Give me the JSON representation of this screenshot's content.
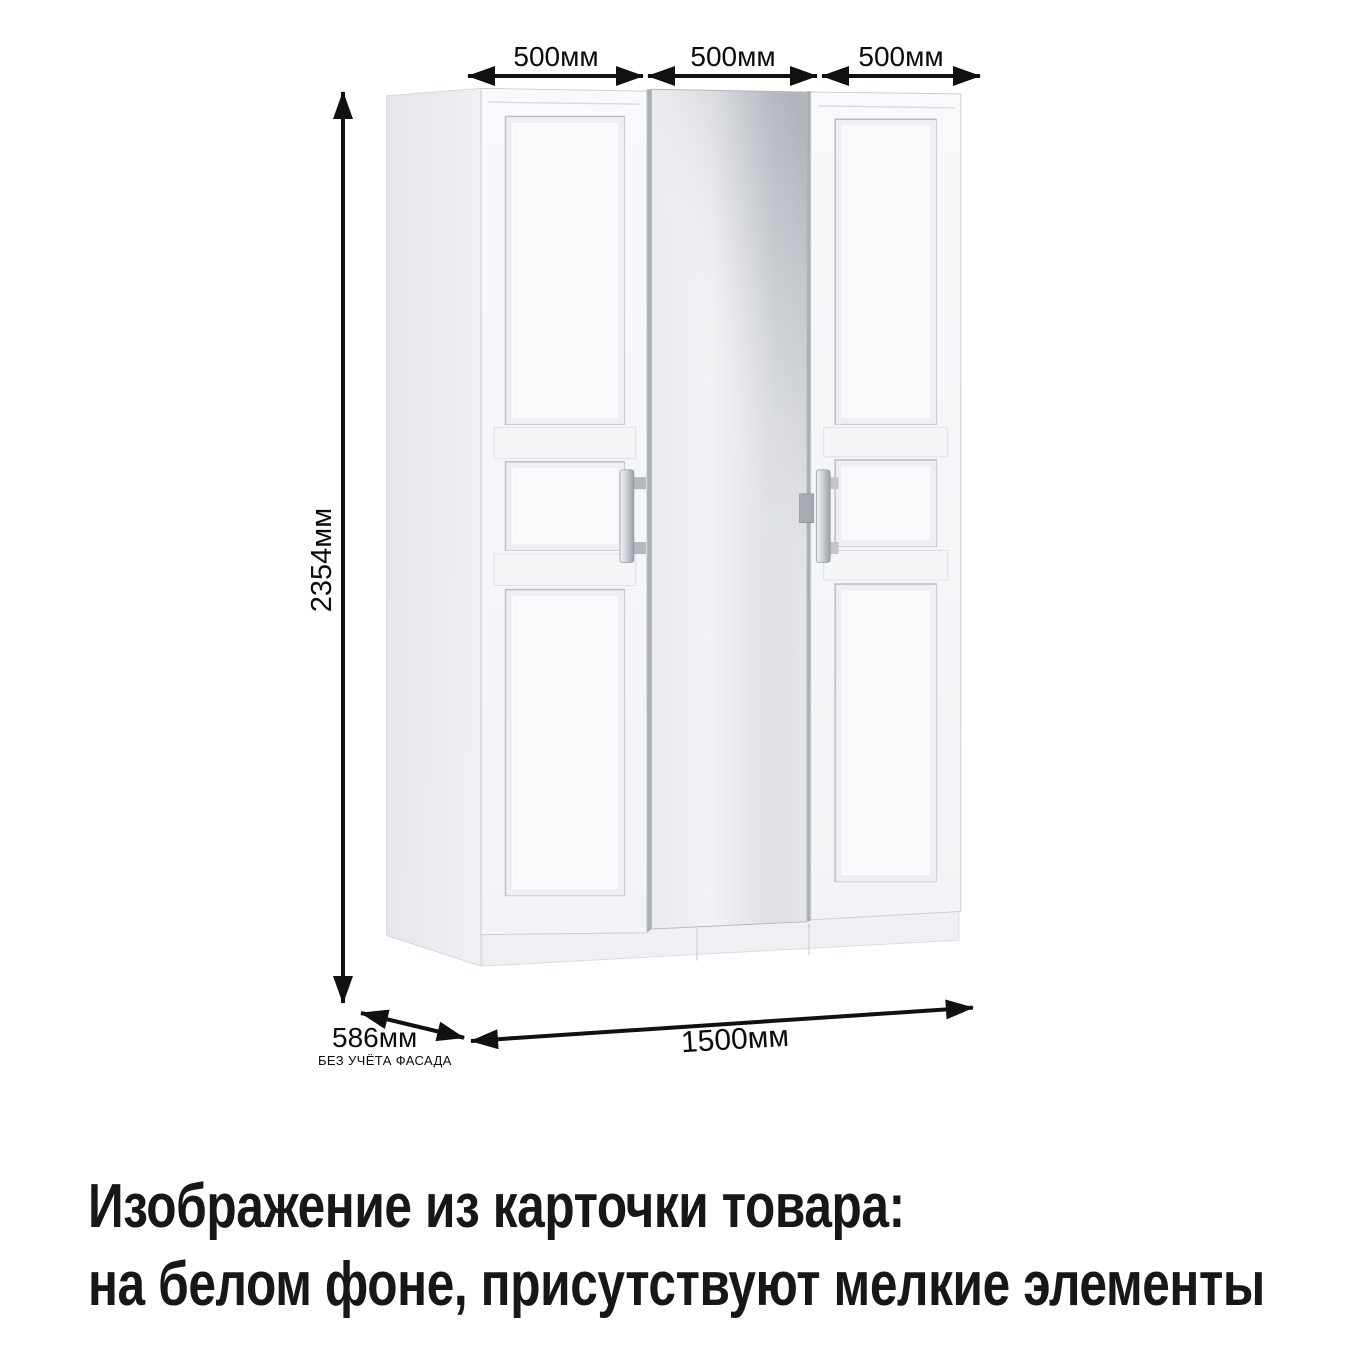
{
  "annotations": {
    "door_width_labels": [
      "500мм",
      "500мм",
      "500мм"
    ],
    "height_label": "2354мм",
    "depth_label": "586мм",
    "depth_sublabel": "БЕЗ УЧЁТА ФАСАДА",
    "total_width_label": "1500мм"
  },
  "caption": {
    "line1": "Изображение из карточки товара:",
    "line2": "на белом фоне, присутствуют мелкие элементы"
  },
  "illustration": {
    "subject": "three-door-wardrobe-with-center-mirror",
    "colors": {
      "background": "#ffffff",
      "arrow": "#111111",
      "door_face": "#f6f7f9",
      "side_panel": "#e8eaed",
      "mirror_light": "#eff1f3",
      "mirror_shadow": "#878e97",
      "handle_silver": "#c9cdd2",
      "outline": "#c6cacf",
      "text": "#0c0c0c"
    }
  }
}
